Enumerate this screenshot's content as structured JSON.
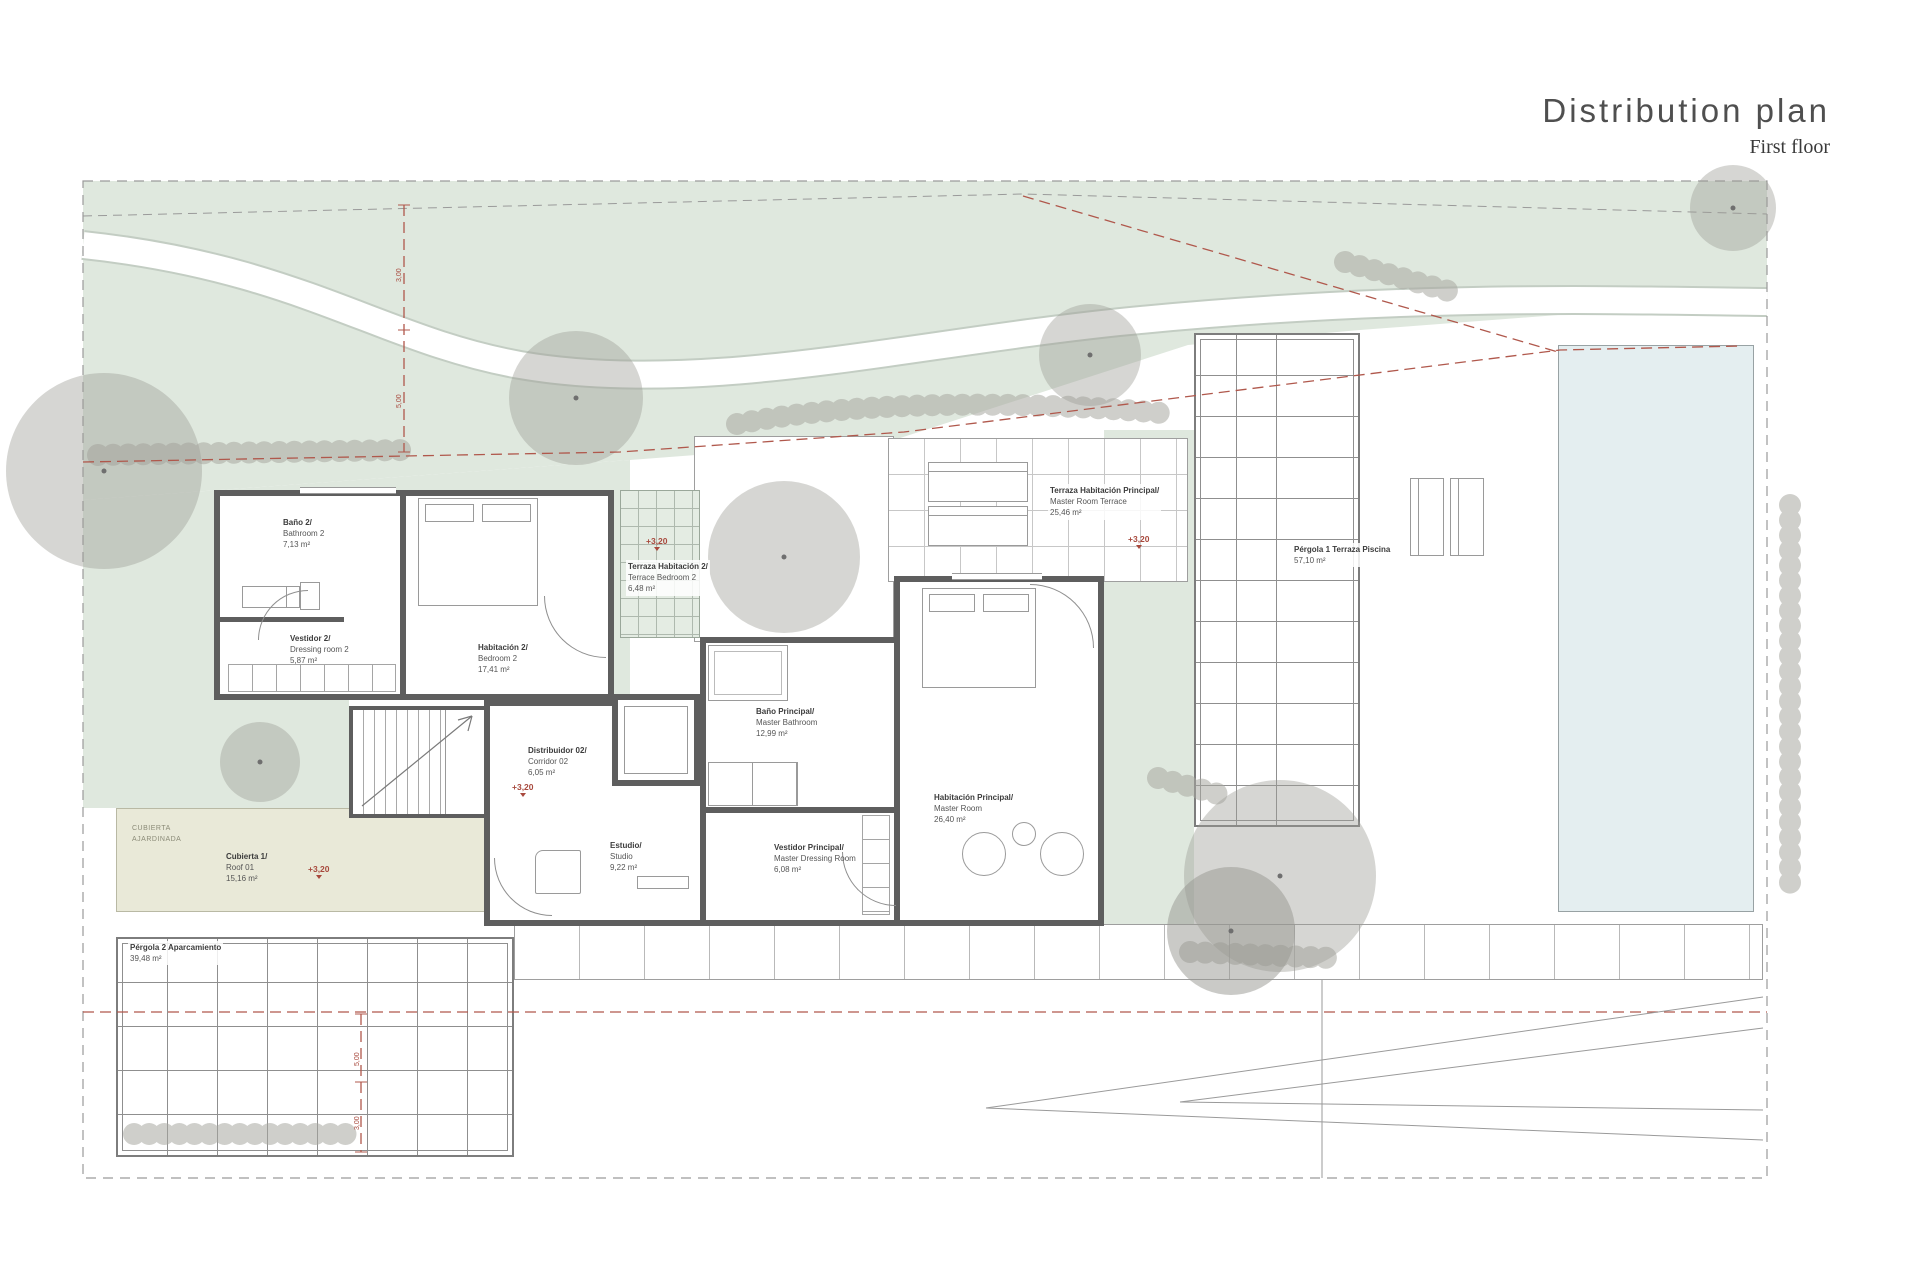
{
  "header": {
    "title": "Distribution plan",
    "subtitle": "First floor"
  },
  "rooms": [
    {
      "id": "bathroom-2",
      "name_es": "Baño 2/",
      "name_en": "Bathroom 2",
      "area": "7,13 m²"
    },
    {
      "id": "dressing-2",
      "name_es": "Vestidor 2/",
      "name_en": "Dressing room 2",
      "area": "5,87 m²"
    },
    {
      "id": "bedroom-2",
      "name_es": "Habitación 2/",
      "name_en": "Bedroom 2",
      "area": "17,41 m²"
    },
    {
      "id": "terrace-bedroom-2",
      "name_es": "Terraza Habitación 2/",
      "name_en": "Terrace Bedroom 2",
      "area": "6,48 m²"
    },
    {
      "id": "terrace-master",
      "name_es": "Terraza Habitación Principal/",
      "name_en": "Master Room Terrace",
      "area": "25,46 m²"
    },
    {
      "id": "pergola-1",
      "name_es": "Pérgola 1 Terraza Piscina",
      "area": "57,10 m²"
    },
    {
      "id": "master-bathroom",
      "name_es": "Baño Principal/",
      "name_en": "Master Bathroom",
      "area": "12,99 m²"
    },
    {
      "id": "corridor-02",
      "name_es": "Distribuidor 02/",
      "name_en": "Corridor 02",
      "area": "6,05 m²"
    },
    {
      "id": "studio",
      "name_es": "Estudio/",
      "name_en": "Studio",
      "area": "9,22 m²"
    },
    {
      "id": "master-dressing",
      "name_es": "Vestidor Principal/",
      "name_en": "Master Dressing Room",
      "area": "6,08 m²"
    },
    {
      "id": "master-room",
      "name_es": "Habitación Principal/",
      "name_en": "Master Room",
      "area": "26,40 m²"
    },
    {
      "id": "roof-01",
      "name_es": "Cubierta 1/",
      "name_en": "Roof 01",
      "area": "15,16 m²"
    },
    {
      "id": "pergola-2",
      "name_es": "Pérgola 2 Aparcamiento",
      "area": "39,48 m²"
    }
  ],
  "annotations": {
    "level_marker": "+3,20",
    "green_roof_line1": "CUBIERTA",
    "green_roof_line2": "AJARDINADA",
    "dim_top_a": "3,00",
    "dim_top_b": "5,00",
    "dim_bottom_a": "5,00",
    "dim_bottom_b": "3,00"
  },
  "colors": {
    "landscape_green": "#dfe8de",
    "pool_blue": "#e4eef0",
    "roof_beige": "#e9e9d8",
    "wall_gray": "#5e5e5e",
    "marker_red": "#a8493d",
    "tree_gray": "#9d9d96"
  }
}
